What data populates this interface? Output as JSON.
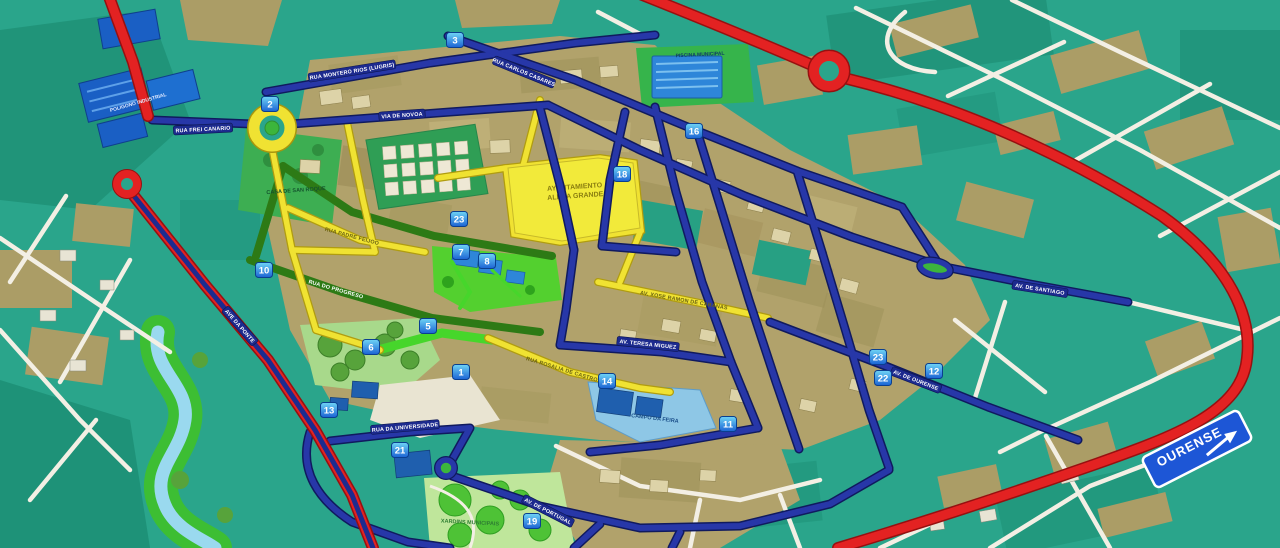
{
  "map": {
    "title": "Stylized street map of a Galician town",
    "town_hall": {
      "line1": "AYUNTAMIENTO",
      "line2": "ALDEA GRANDE"
    },
    "sign": {
      "text": "OURENSE",
      "direction": "right"
    },
    "markers": [
      {
        "label": "2",
        "x": 270,
        "y": 104
      },
      {
        "label": "3",
        "x": 455,
        "y": 40
      },
      {
        "label": "16",
        "x": 694,
        "y": 131
      },
      {
        "label": "18",
        "x": 622,
        "y": 174
      },
      {
        "label": "23",
        "x": 459,
        "y": 219
      },
      {
        "label": "7",
        "x": 461,
        "y": 252
      },
      {
        "label": "8",
        "x": 487,
        "y": 261
      },
      {
        "label": "10",
        "x": 264,
        "y": 270
      },
      {
        "label": "5",
        "x": 428,
        "y": 326
      },
      {
        "label": "6",
        "x": 371,
        "y": 347
      },
      {
        "label": "1",
        "x": 461,
        "y": 372
      },
      {
        "label": "13",
        "x": 329,
        "y": 410
      },
      {
        "label": "21",
        "x": 400,
        "y": 450
      },
      {
        "label": "14",
        "x": 607,
        "y": 381
      },
      {
        "label": "23",
        "x": 878,
        "y": 357
      },
      {
        "label": "22",
        "x": 883,
        "y": 378
      },
      {
        "label": "12",
        "x": 934,
        "y": 371
      },
      {
        "label": "11",
        "x": 728,
        "y": 424
      },
      {
        "label": "19",
        "x": 532,
        "y": 521
      }
    ],
    "street_labels": [
      {
        "text": "RUA MONTERO RIOS (LUGRIS)",
        "x": 352,
        "y": 71,
        "angle": -9,
        "style": "blue"
      },
      {
        "text": "RUA CARLOS CASARES",
        "x": 524,
        "y": 72,
        "angle": 22,
        "style": "blue"
      },
      {
        "text": "VIA DE NOVOA",
        "x": 402,
        "y": 115,
        "angle": -4,
        "style": "blue"
      },
      {
        "text": "RUA FREI CANARIO",
        "x": 203,
        "y": 129,
        "angle": -3,
        "style": "blue"
      },
      {
        "text": "AVE DA PONTE",
        "x": 240,
        "y": 326,
        "angle": 49,
        "style": "blue"
      },
      {
        "text": "RUA DO PROGRESO",
        "x": 336,
        "y": 289,
        "angle": 16,
        "style": "green"
      },
      {
        "text": "RUA PADRE FEIJOO",
        "x": 352,
        "y": 236,
        "angle": 15,
        "style": "yellow"
      },
      {
        "text": "AV. XOSE RAMON DE CABANAS",
        "x": 684,
        "y": 300,
        "angle": 10,
        "style": "yellow"
      },
      {
        "text": "RUA ROSALIA DE CASTRO",
        "x": 562,
        "y": 369,
        "angle": 17,
        "style": "yellow"
      },
      {
        "text": "AV. TERESA MIGUEZ",
        "x": 648,
        "y": 344,
        "angle": 6,
        "style": "blue"
      },
      {
        "text": "AV. DE OURENSE",
        "x": 916,
        "y": 380,
        "angle": 21,
        "style": "blue"
      },
      {
        "text": "RUA DA UNIVERSIDADE",
        "x": 405,
        "y": 427,
        "angle": -5,
        "style": "blue"
      },
      {
        "text": "AV. DE PORTUGAL",
        "x": 548,
        "y": 511,
        "angle": 27,
        "style": "blue"
      },
      {
        "text": "AV. DE SANTIAGO",
        "x": 1040,
        "y": 289,
        "angle": 9,
        "style": "blue"
      }
    ],
    "area_labels": [
      {
        "text": "CASA DE SAN ROQUE",
        "x": 296,
        "y": 190,
        "angle": -4,
        "color": "#14532d",
        "size": 5.5
      },
      {
        "text": "PISCINA MUNICIPAL",
        "x": 700,
        "y": 54,
        "angle": -3,
        "color": "#0f3d66",
        "size": 5
      },
      {
        "text": "POLIGONO INDUSTRIAL",
        "x": 138,
        "y": 102,
        "angle": -16,
        "color": "#dfe9ff",
        "size": 5
      },
      {
        "text": "CAMPO DA FEIRA",
        "x": 655,
        "y": 418,
        "angle": 7,
        "color": "#1b4f8a",
        "size": 5.5
      },
      {
        "text": "XARDINS MUNICIPAIS",
        "x": 470,
        "y": 522,
        "angle": 3,
        "color": "#2e7d32",
        "size": 5.5
      }
    ],
    "colors": {
      "background": "#2aa58b",
      "road_blue": "#2737a8",
      "road_yellow": "#f0e232",
      "road_red": "#e32222",
      "road_green": "#2d7a15",
      "road_bright_green": "#46d62b",
      "road_white": "#f3efe4",
      "water": "#9ad9ef",
      "marker": "#1b63d4",
      "sign": "#1d56d6"
    }
  }
}
